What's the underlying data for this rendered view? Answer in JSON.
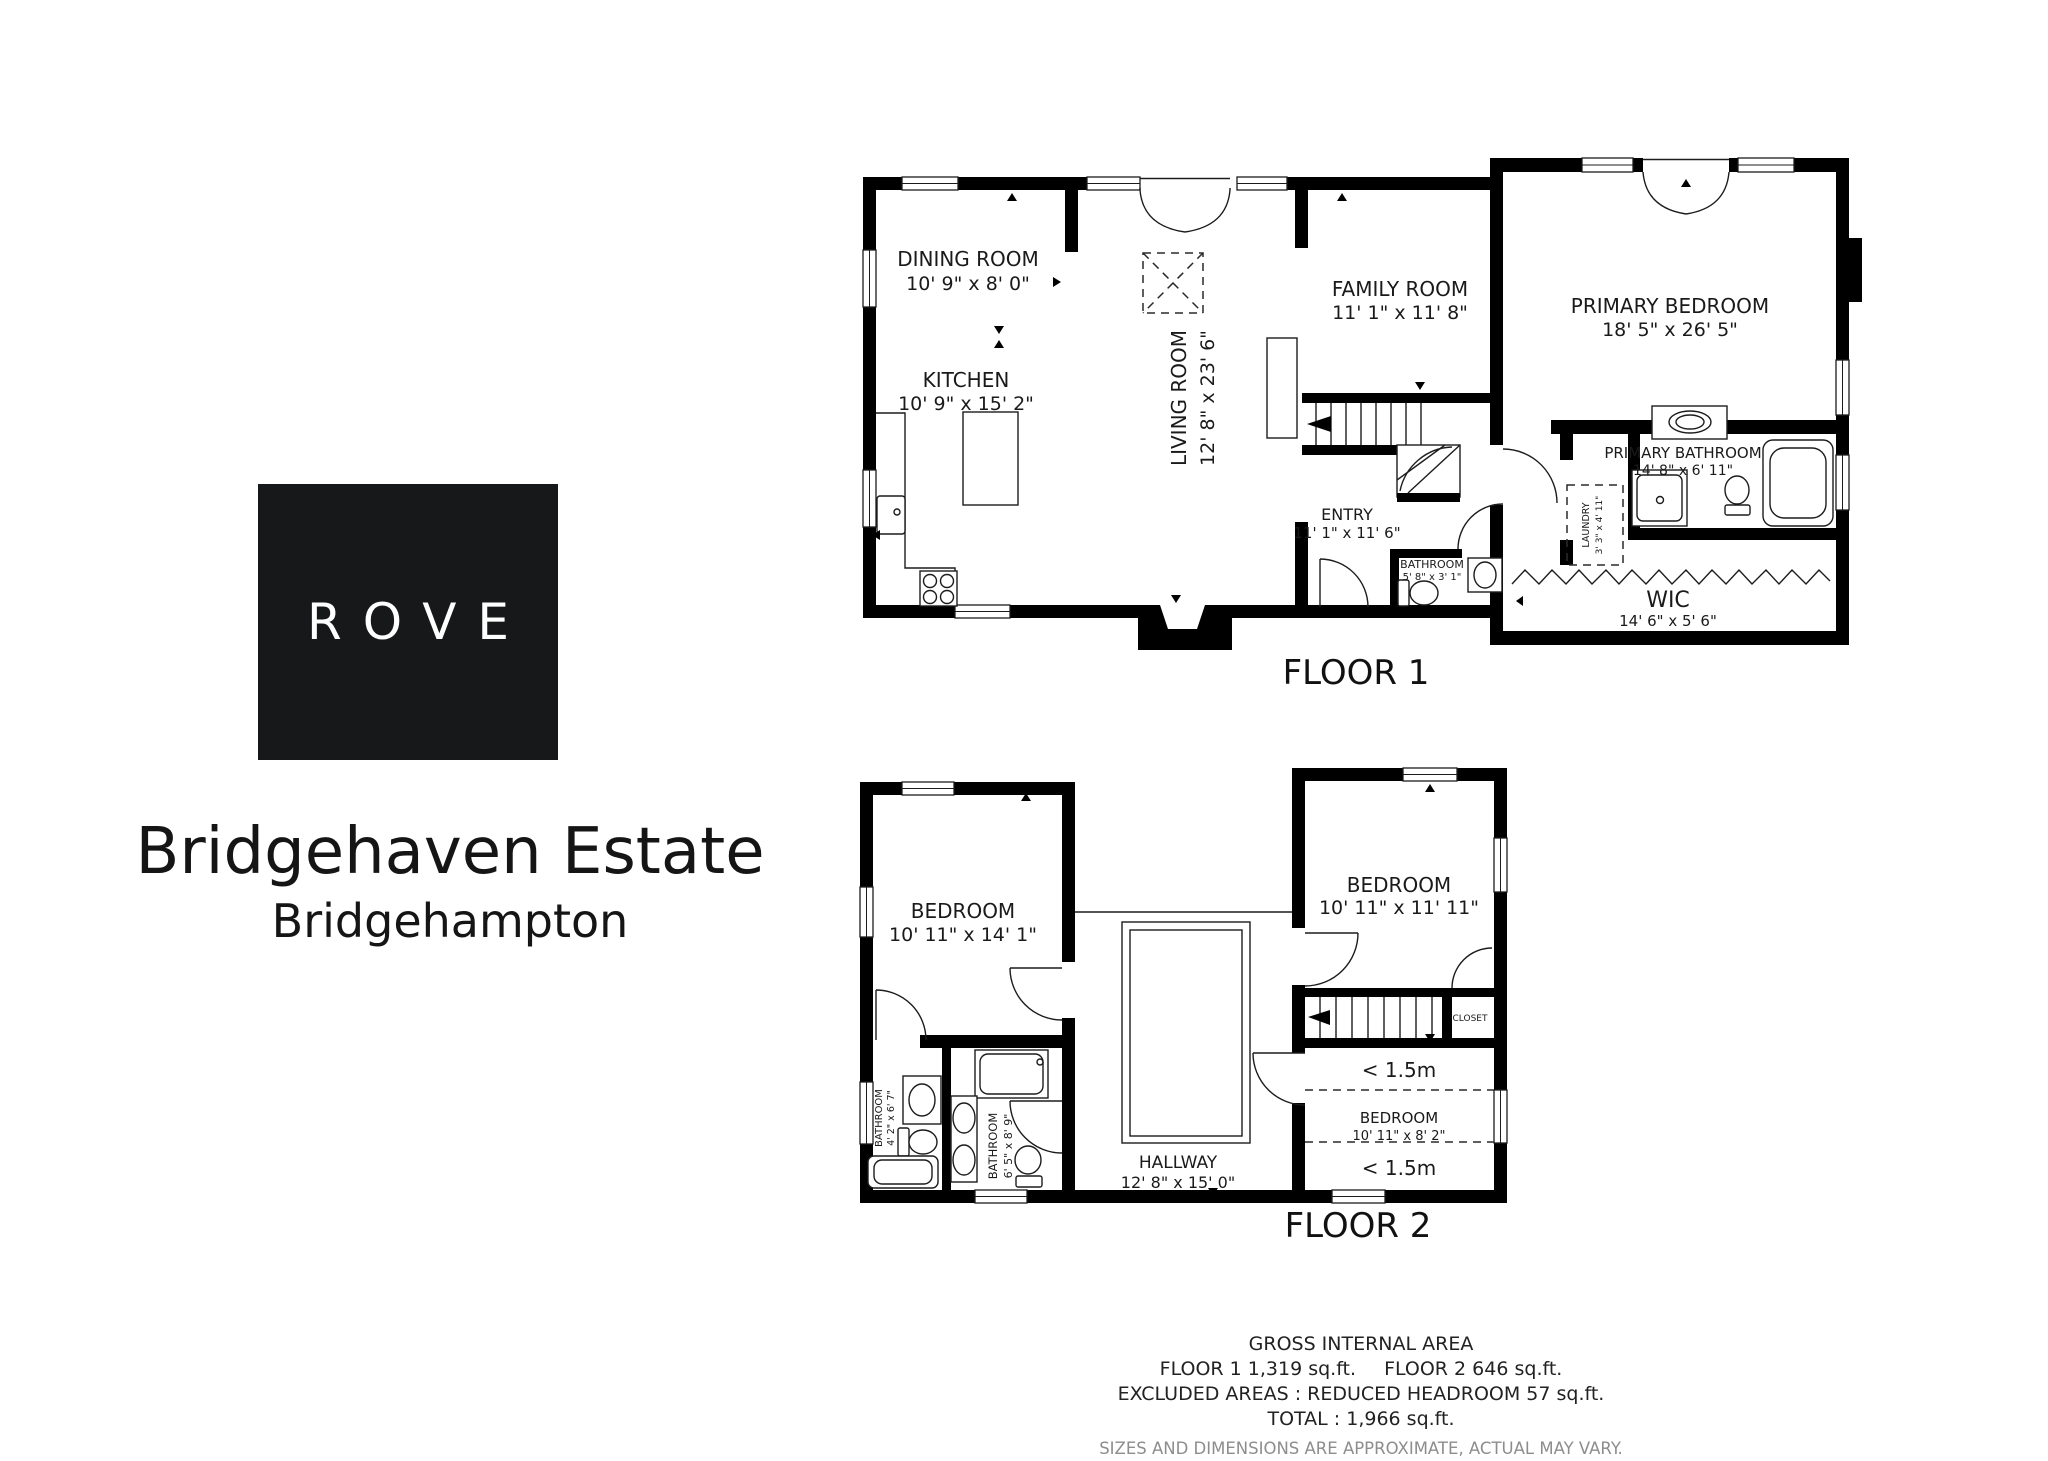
{
  "logo": {
    "text": "ROVE"
  },
  "title": "Bridgehaven Estate",
  "subtitle": "Bridgehampton",
  "floor1": {
    "label": "FLOOR 1",
    "rooms": {
      "dining": {
        "name": "DINING ROOM",
        "dims": "10' 9\" x 8' 0\""
      },
      "kitchen": {
        "name": "KITCHEN",
        "dims": "10' 9\" x 15' 2\""
      },
      "living": {
        "name": "LIVING ROOM",
        "dims": "12' 8\" x 23' 6\""
      },
      "family": {
        "name": "FAMILY ROOM",
        "dims": "11' 1\" x 11' 8\""
      },
      "entry": {
        "name": "ENTRY",
        "dims": "11' 1\" x 11' 6\""
      },
      "bathroom": {
        "name": "BATHROOM",
        "dims": "5' 8\" x 3' 1\""
      },
      "primary_bedroom": {
        "name": "PRIMARY BEDROOM",
        "dims": "18' 5\" x 26' 5\""
      },
      "primary_bathroom": {
        "name": "PRIMARY BATHROOM",
        "dims": "14' 8\" x 6' 11\""
      },
      "laundry": {
        "name": "LAUNDRY",
        "dims": "3' 3\" x 4' 11\""
      },
      "wic": {
        "name": "WIC",
        "dims": "14' 6\" x 5' 6\""
      }
    }
  },
  "floor2": {
    "label": "FLOOR 2",
    "headroom_label": "< 1.5m",
    "rooms": {
      "bedroom_left": {
        "name": "BEDROOM",
        "dims": "10' 11\" x 14' 1\""
      },
      "bedroom_right": {
        "name": "BEDROOM",
        "dims": "10' 11\" x 11' 11\""
      },
      "bedroom_small": {
        "name": "BEDROOM",
        "dims": "10' 11\" x 8' 2\""
      },
      "bathroom_left": {
        "name": "BATHROOM",
        "dims": "4' 2\" x 6' 7\""
      },
      "bathroom_right": {
        "name": "BATHROOM",
        "dims": "6' 5\" x 8' 9\""
      },
      "hallway": {
        "name": "HALLWAY",
        "dims": "12' 8\" x 15' 0\""
      },
      "closet": {
        "name": "CLOSET"
      }
    }
  },
  "footer": {
    "line1": "GROSS INTERNAL AREA",
    "floor1_area": "FLOOR 1 1,319 sq.ft.",
    "floor2_area": "FLOOR 2 646 sq.ft.",
    "line3": "EXCLUDED AREAS :  REDUCED HEADROOM 57 sq.ft.",
    "line4": "TOTAL :  1,966 sq.ft.",
    "disclaimer": "SIZES AND DIMENSIONS ARE APPROXIMATE, ACTUAL MAY VARY."
  }
}
